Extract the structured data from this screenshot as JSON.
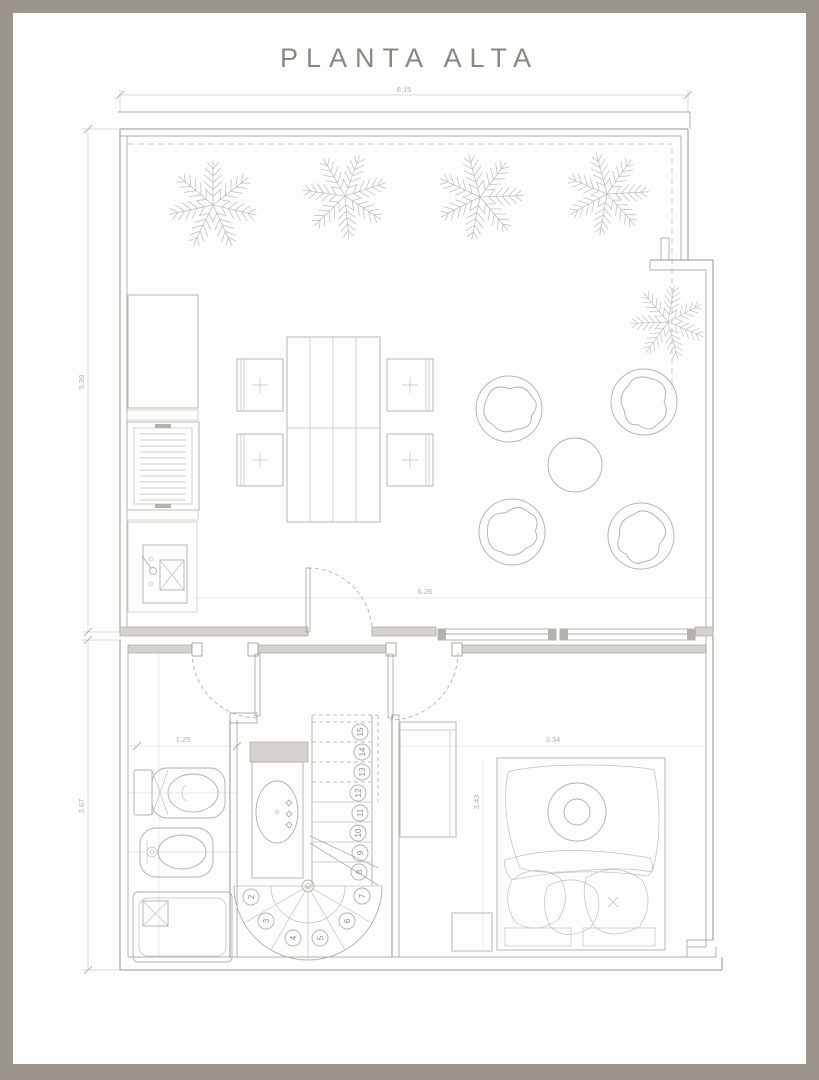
{
  "title": "PLANTA ALTA",
  "dimensions": {
    "top_width": "8.15",
    "upper_left_height": "5.39",
    "living_width": "6.26",
    "lower_left_height": "3.67",
    "bathroom_width": "1.25",
    "bedroom_width": "3.34",
    "bedroom_height": "3.43"
  },
  "stairs": {
    "steps": [
      "2",
      "3",
      "4",
      "5",
      "6",
      "7",
      "8",
      "9",
      "10",
      "11",
      "12",
      "13",
      "14",
      "15"
    ]
  },
  "colors": {
    "frame": "#9c958d",
    "wall_line": "#9a968f",
    "furniture_line": "#b2afa9",
    "dimension_text": "#b4b1ac",
    "title_text": "#8a8783",
    "paper": "#fdfdfc"
  }
}
